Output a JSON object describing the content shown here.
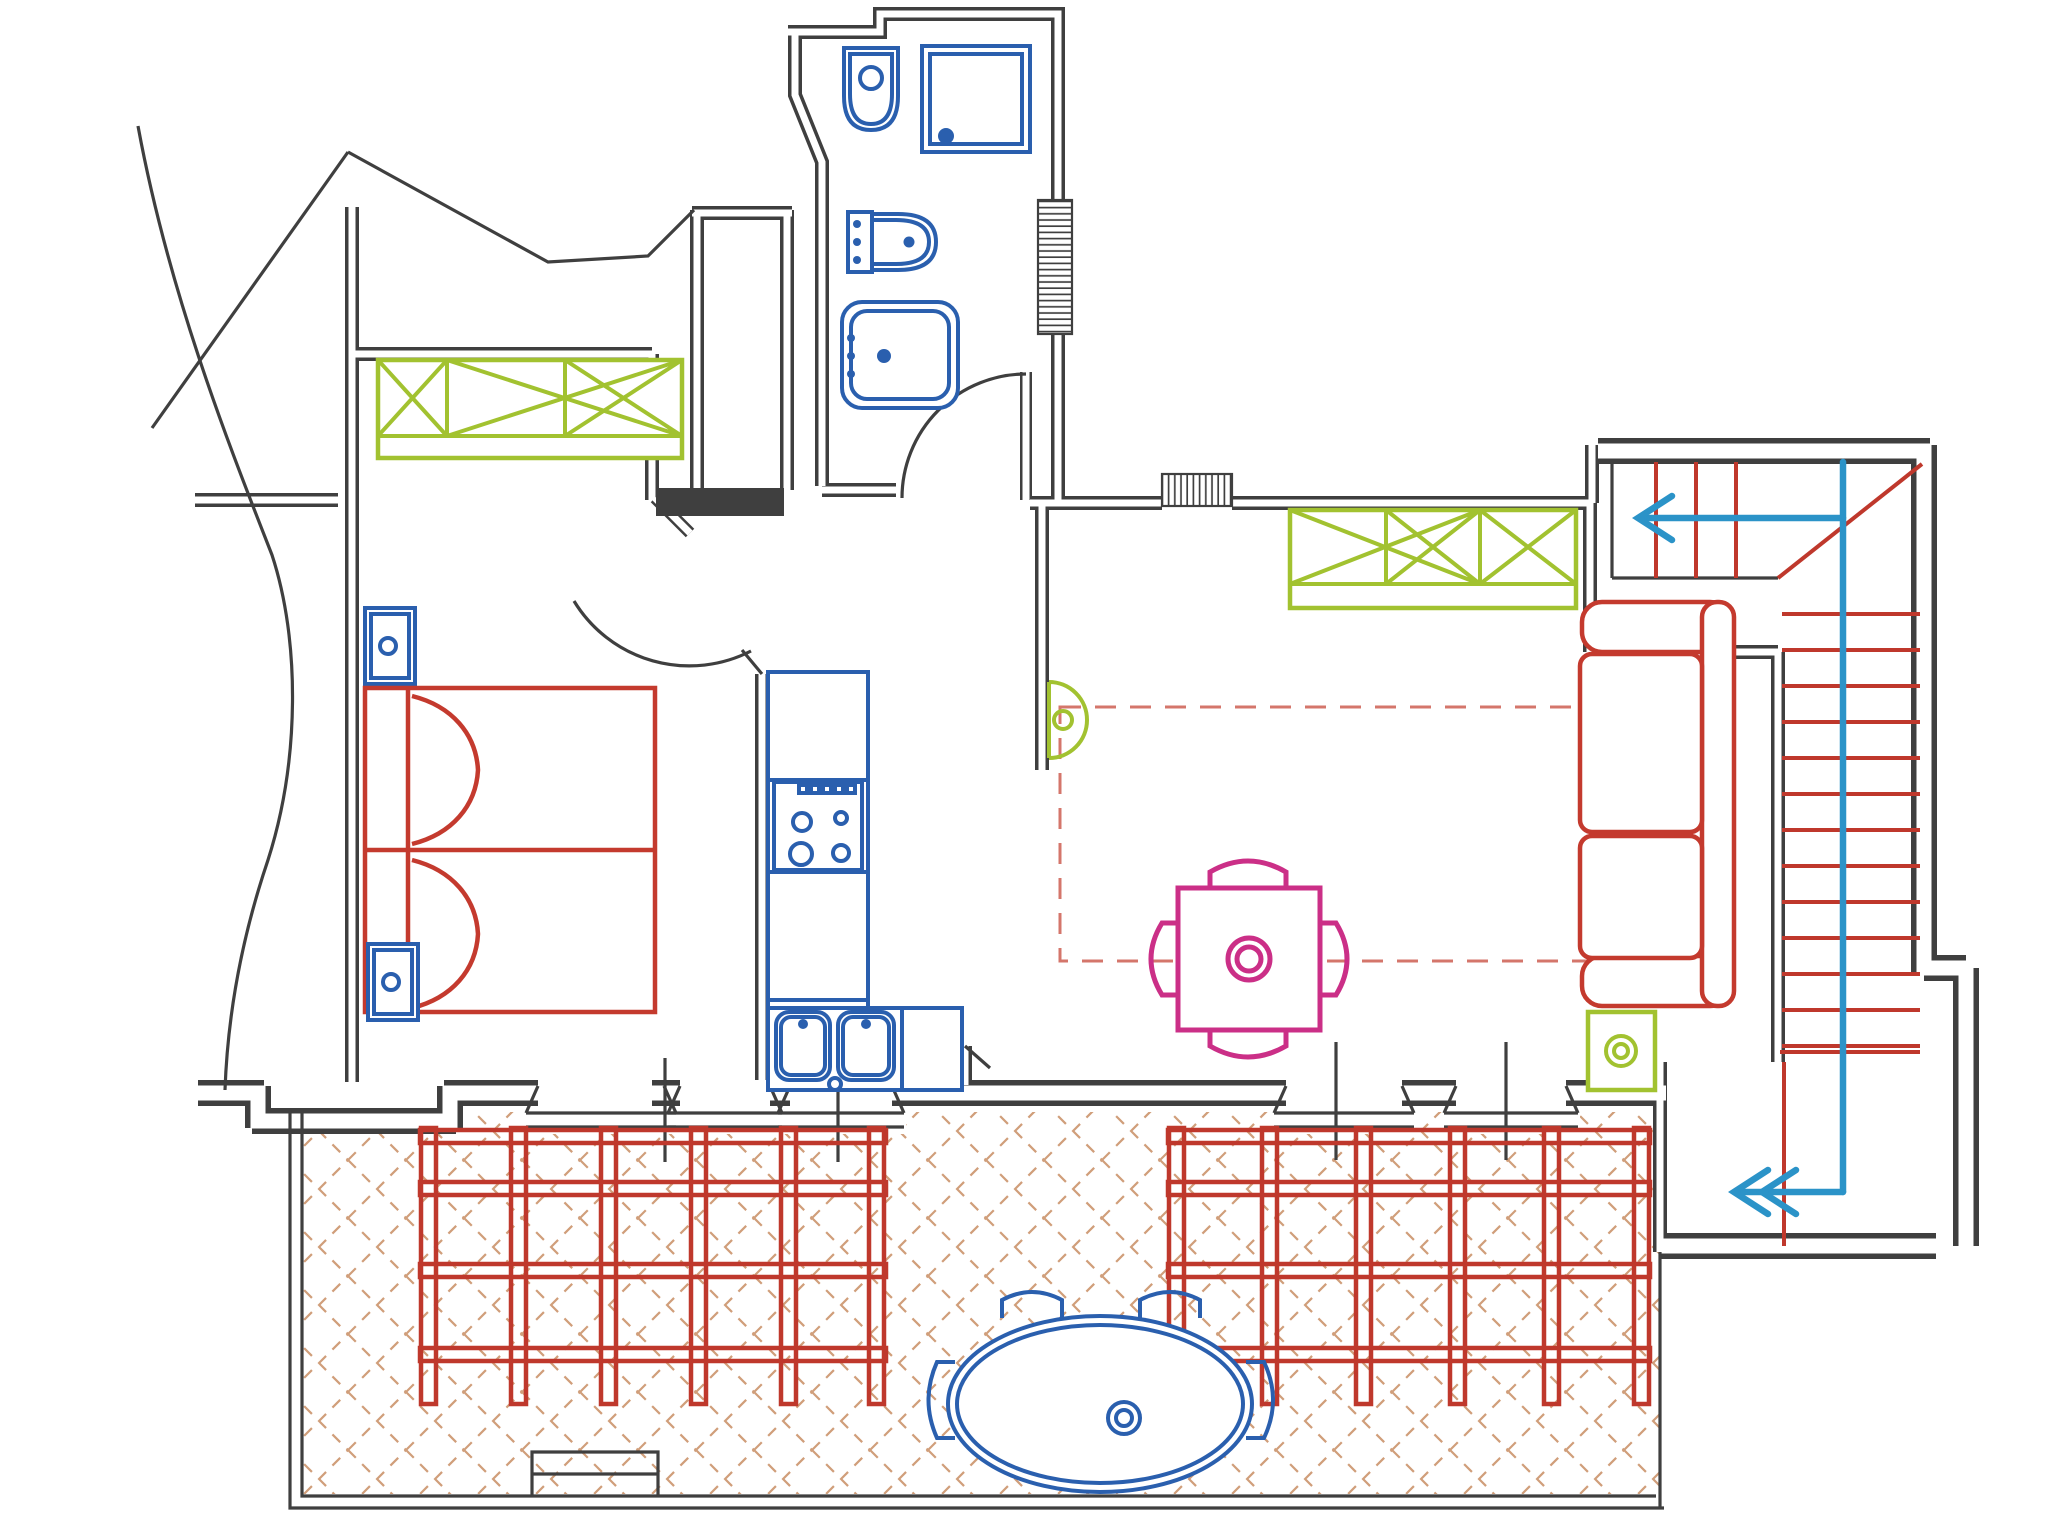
{
  "document": {
    "type": "architectural-floor-plan",
    "view": "top-down apartment plan with terrace and staircase",
    "visible_text": []
  },
  "colors": {
    "paper": "#ffffff",
    "wall": "#3f3f3f",
    "site_line": "#4a4a4a",
    "plumbing_blue": "#2a5fae",
    "furniture_red": "#c43a2e",
    "wardrobe_green": "#a2c230",
    "table_magenta": "#cb2f87",
    "stair_red": "#bf382c",
    "stair_arrow_cyan": "#2b93c8",
    "terrace_hatch": "#d09e7a",
    "carpet_dash_red": "#d4766b"
  },
  "rooms": [
    {
      "name": "bathroom",
      "fixtures": [
        "toilet",
        "shower",
        "bidet",
        "washbasin"
      ],
      "window_hatches": 1
    },
    {
      "name": "bedroom",
      "furniture": [
        "double-bed",
        "two-pillows",
        "nightstand",
        "nightstand",
        "wardrobe-crossed"
      ]
    },
    {
      "name": "hallway",
      "features": [
        "bathroom-door-arc",
        "bedroom-door-arc",
        "duct-solid-fill"
      ]
    },
    {
      "name": "kitchen",
      "fixtures": [
        "l-shaped-counter",
        "stove-4-burners",
        "double-sink",
        "wall-hung-green-basin"
      ]
    },
    {
      "name": "living-dining-room",
      "furniture": [
        "wardrobe-crossed",
        "dashed-carpet",
        "square-dining-table",
        "four-chairs",
        "two-seat-sofa",
        "green-side-table"
      ],
      "window_hatches": 1
    },
    {
      "name": "staircase",
      "upper_treads": 3,
      "lower_treads": 14,
      "winder_diagonal": 1,
      "direction_arrows": 2
    },
    {
      "name": "entrance-vestibule",
      "features": [
        "entry-arrow"
      ]
    },
    {
      "name": "terrace",
      "features": [
        "cross-hatch-paving",
        "pergola-left",
        "pergola-right",
        "oval-outdoor-table",
        "four-outdoor-chairs",
        "bottom-step-recess"
      ]
    }
  ],
  "pergola": {
    "sections": 2,
    "beams_per_section": 4,
    "posts_per_section": 6
  },
  "south_wall_openings": 5,
  "icons": [
    "stair-up-arrow-icon",
    "entrance-arrow-icon"
  ]
}
